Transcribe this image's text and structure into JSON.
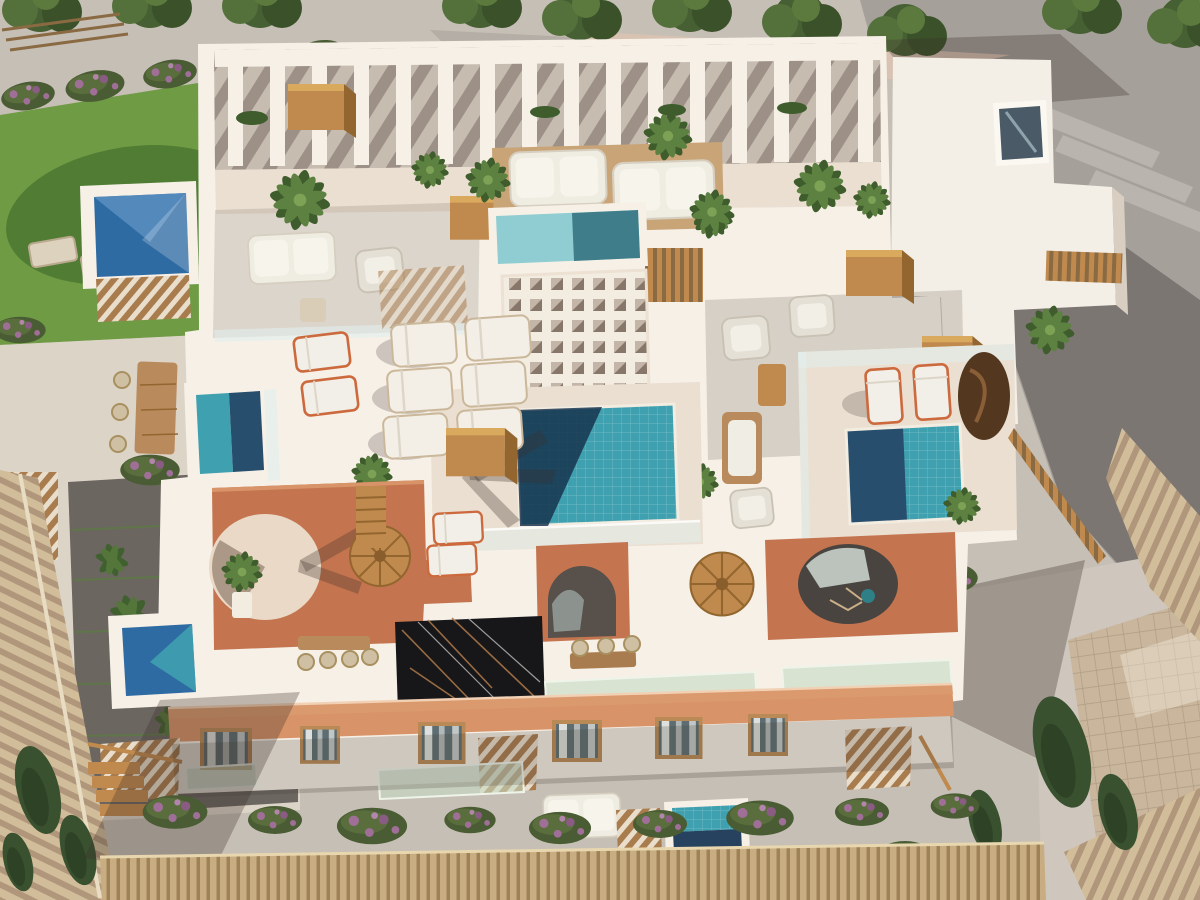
{
  "scene": {
    "type": "aerial 3D architectural rendering",
    "subject": "bird's-eye oblique view of a Mediterranean apartment building with rooftop terraces and plunge pools",
    "lighting": "strong sunlight from the upper right casting long shadows toward the lower left",
    "surroundings": "asphalt streets above and right, lawn garden upper left, neighbouring barrel-tile roofs and cypress trees lower corners, reed fence along the bottom"
  },
  "palette": {
    "wall_lit": "#f6f0e7",
    "wall_shadow": "#d9cec2",
    "terrace_lit": "#eadfd0",
    "terrace_shadow": "#c3b3a7",
    "pergola_floor": "#c7bcb0",
    "terracotta": "#c4754f",
    "terracotta_light": "#d89468",
    "terracotta_dark": "#9e5a3e",
    "pool_turquoise": "#3fa0b0",
    "pool_deep": "#274e6d",
    "pool_royal": "#2f6ba3",
    "pool_pale": "#8fcdd2",
    "wood": "#c08a4e",
    "wood_dark": "#93662f",
    "glass": "#d7e6df",
    "canopy_green": "#cfe0c8",
    "marble": "#17171a",
    "road_light": "#c6bfb5",
    "road_mid": "#a5a09a",
    "road_dark": "#7b7672",
    "pave_dark": "#6b6660",
    "lawn": "#6f9b45",
    "lawn_shadow": "#507c33",
    "leaf": "#5d8140",
    "leaf_dark": "#3e5c2c",
    "flower": "#a06f98",
    "roof_tile": "#d2bd9b",
    "roof_tile_dark": "#b0967a",
    "reed": "#c9ad82",
    "shadow": "#3a2f28"
  },
  "features": [
    "white rooftop pergola with beam columns along the top edge",
    "seven blue tiled pools of varying size",
    "large central turquoise pool half covered by palm shadow",
    "white waffle-lattice shade roof",
    "terracotta courtyard slab with circular patio opening and arched loggias",
    "two spiral staircases and tan stair canopies",
    "black marble roof panel with bronze veins",
    "terracotta cornice band over a white facade with wood framed windows",
    "pale green glass balcony canopies",
    "white and orange framed sun loungers, outdoor sofas, dining tables",
    "potted palms and ferns, bougainvillea hedges with purple blooms",
    "lawn with two loungers, streets with tree shadows, neighbouring tiled roofs, reed fence"
  ]
}
